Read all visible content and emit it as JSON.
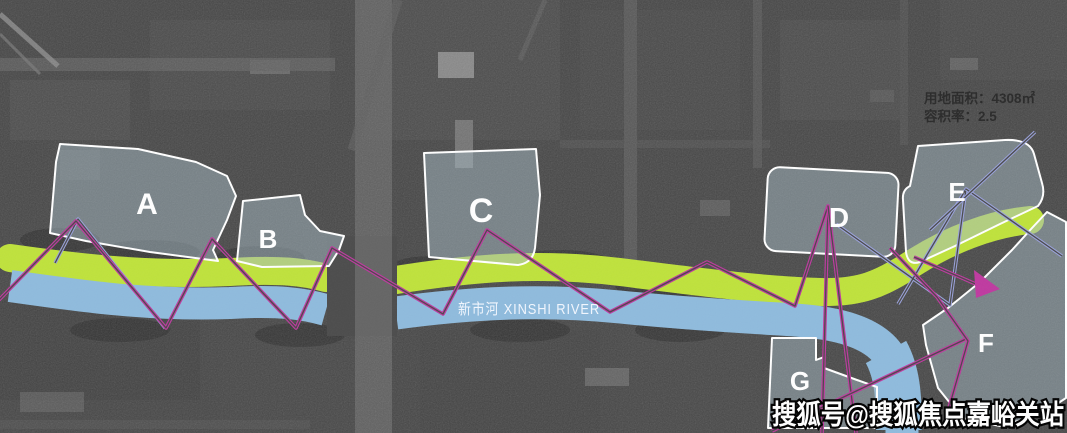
{
  "colors": {
    "background": "#464646",
    "greenway": "#bfe23c",
    "river": "#8fbbdd",
    "zone_fill": "rgba(165,185,195,0.5)",
    "zone_border": "#ffffff",
    "corridor_magenta": "#bf3aa0",
    "corridor_blue": "#9aa2dc"
  },
  "info_panel": {
    "site_area": "用地面积：4308㎡",
    "plot_ratio": "容积率：2.5"
  },
  "river": {
    "label": "新市河  XINSHI RIVER"
  },
  "zones": [
    {
      "label": "A"
    },
    {
      "label": "B"
    },
    {
      "label": "C"
    },
    {
      "label": "D"
    },
    {
      "label": "E"
    },
    {
      "label": "F"
    },
    {
      "label": "G"
    }
  ],
  "watermark": {
    "text": "搜狐号@搜狐焦点嘉峪关站"
  }
}
